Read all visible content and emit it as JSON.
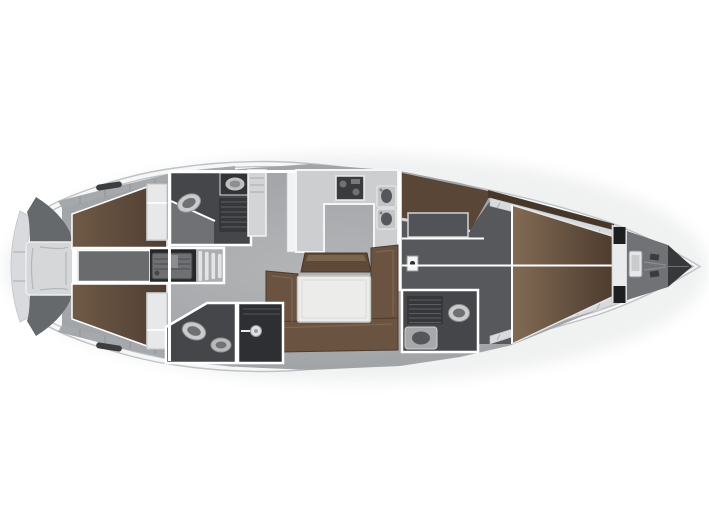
{
  "plan": {
    "type": "yacht-interior-floor-plan",
    "orientation": "bow-right",
    "regions": [
      "stern-swim-platform",
      "stern-lockers",
      "stern-center-seat",
      "aft-cabin-port",
      "aft-cabin-starboard",
      "aft-berth-port",
      "aft-berth-starboard",
      "engine-compartment",
      "engine-hatch",
      "companionway-steps",
      "aft-head-port",
      "aft-head-starboard",
      "shower-stall",
      "wardrobe",
      "galley",
      "stove",
      "sink-double",
      "salon",
      "settee-u",
      "salon-table",
      "sideboard-bench",
      "mast-post",
      "owner-cabin",
      "vanity-seat",
      "forward-head",
      "v-berth",
      "bow-side-shelves",
      "chain-locker",
      "windlass",
      "bow-tip"
    ],
    "fixtures": [
      "toilet",
      "washbasin",
      "shower-grate",
      "shower-head-icon",
      "anchor-chain"
    ]
  },
  "colors": {
    "page_bg": "#ffffff",
    "hull_fill": "#fbfcfd",
    "hull_edge": "#bfc2c4",
    "deck_inner_line": "#e0e2e4",
    "deck_band_gray": "#a6a9ab",
    "deck_tick": "#8f9294",
    "floor_gray": "#a4a7aa",
    "floor_dark": "#56585c",
    "wall_white": "#ffffff",
    "berth_brown": "#63503f",
    "berth_brown_dark": "#4e3d31",
    "berth_brown_light": "#75604b",
    "settee_brown": "#6a5340",
    "settee_edge": "#4d3b2d",
    "bench_brown": "#5e4939",
    "bench_face_light": "#7c654f",
    "table_top": "#ecedeb",
    "table_edge": "#c6c8c6",
    "vanity_brown": "#5a4636",
    "wood_wedge_dark": "#46372b",
    "head_dark": "#45464a",
    "head_entry_gray": "#6f7174",
    "shower_dark": "#2e2f32",
    "grate_dark": "#36373a",
    "grate_line": "#5d5f63",
    "engine_dark": "#26272a",
    "engine_hatch": "#696b6d",
    "machinery_gray": "#6e7073",
    "counter_light": "#ccced0",
    "stove_dark": "#3a3b3d",
    "sink_light": "#c3c5c7",
    "basin_dark": "#55575a",
    "fixture_light": "#c9cbcd",
    "fixture_inner": "#6f7173",
    "wardrobe_light": "#d2d4d6",
    "nightstand_light": "#e6e8ea",
    "steps_light": "#e2e4e5",
    "transom_band": "#d8dade",
    "stern_locker_dark": "#66696c",
    "stern_seat": "#d5d7d9",
    "stern_seat_line": "#b4b6b8",
    "shelf_light": "#d8dade",
    "shelf_tick": "#a9abad",
    "bulkhead_band": "#e9ebed",
    "hatch_black": "#1d1e20",
    "anchor_locker": "#707275",
    "windlass_light": "#e6e7e8",
    "chain_gray": "#8a8c8e",
    "bow_tip_dark": "#37383a",
    "mast_post_light": "#f4f5f5"
  }
}
